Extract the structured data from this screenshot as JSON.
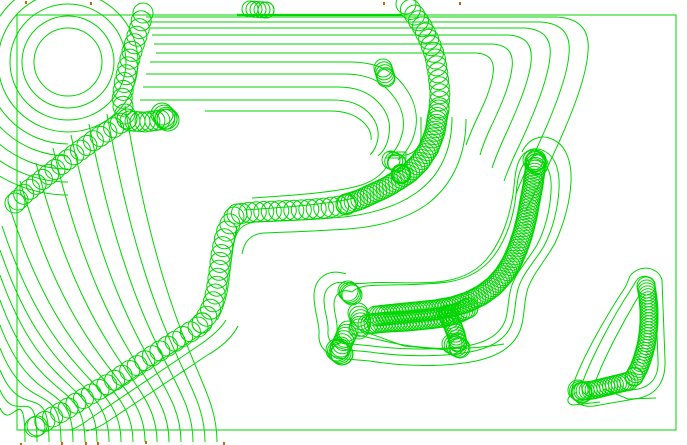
{
  "app": {
    "description": "CAM trochoidal toolpath preview viewport",
    "canvas": {
      "width": 687,
      "height": 445,
      "background": "#ffffff"
    },
    "colors": {
      "toolpath": "#00d600",
      "endpoint_marker": "#c86410"
    }
  },
  "border": {
    "x": 17,
    "y": 15,
    "w": 659,
    "h": 415
  },
  "boss_circles": [
    {
      "cx": 68,
      "cy": 62,
      "r": 34
    },
    {
      "cx": 68,
      "cy": 62,
      "r": 46
    },
    {
      "cx": 68,
      "cy": 62,
      "r": 58
    },
    {
      "cx": 68,
      "cy": 62,
      "r": 70
    }
  ],
  "boss_half_arc_radii": [
    82,
    94,
    107,
    120,
    133
  ],
  "boss_center": {
    "cx": 68,
    "cy": 62
  },
  "bold_circle": {
    "cx": 401,
    "cy": 174,
    "r": 9,
    "sw": 2.4
  },
  "thick_segments": [
    {
      "d": "M 237 15 L 402 15",
      "sw": 2.2
    }
  ],
  "contours": [
    "M 146 17 H 556 C 580 18 590 30 588 52 C 586 82 566 128 548 166 C 540 183 532 198 526 210",
    "M 148 22 H 540 C 562 23 571 34 569 54 C 567 80 550 120 535 152 C 528 166 521 180 516 194",
    "M 150 28 H 524 C 544 29 552 39 550 57 C 548 80 533 116 519 146 C 513 158 508 170 504 181",
    "M 152 35 H 508 C 526 36 533 45 531 62 C 529 82 516 112 504 138 C 499 149 495 159 492 168",
    "M 154 44 H 492 C 508 45 514 53 512 68 C 510 86 499 110 489 131 C 485 140 482 148 480 155",
    "M 156 53 H 476 C 490 54 495 61 493 74 C 491 90 482 108 474 125 C 471 132 468 139 466 145",
    "M 150 62 H 350 C 372 62 388 68 399 80 C 412 94 418 110 416 126 C 414 140 408 151 398 160",
    "M 146 74 H 344 C 364 74 378 79 388 90 C 400 102 405 116 403 130 C 401 141 396 151 388 158",
    "M 143 87 H 338 C 356 87 368 92 377 101 C 387 111 391 122 389 134 C 388 143 384 151 378 156",
    "M 140 100 H 333 C 349 100 360 104 368 112 C 376 120 379 129 378 138 C 377 145 374 151 370 155",
    "M 205 111 H 330 C 344 111 354 114 362 121 C 369 127 372 134 371 140",
    "M 421 117 L 421 136 C 421 146 415 153 406 155 L 388 156",
    "M 386 152 L 406 152 L 406 158 L 386 158",
    "M 452 117 C 452 150 440 176 416 193 C 396 207 370 214 344 217 C 312 220 282 221 256 222 C 242 223 236 231 234 243",
    "M 466 119 C 466 156 452 186 426 205 C 404 220 376 227 348 229 C 318 231 290 232 264 233 C 250 234 244 242 242 254",
    "M 252 198 C 300 195 336 192 358 186 C 372 182 380 176 386 168",
    "M 244 210 C 290 207 330 204 354 198",
    "M 237 226 C 233 244 231 262 229 280 C 227 296 223 310 217 320",
    "M 212 326 C 196 338 178 350 160 360 L 104 398",
    "M 226 320 C 220 330 210 338 198 346 L 88 420 C 80 426 74 429 70 430",
    "M 238 326 C 232 338 220 348 206 356 L 110 420 C 100 427 92 430 86 431",
    "M 352 292 C 342 288 334 294 334 304 C 334 314 338 322 337 330 C 336 338 342 343 352 344 L 372 346 C 404 350 440 350 466 346 C 490 342 502 332 506 318 C 509 306 508 296 512 285 C 517 271 528 260 537 245 C 545 230 550 210 551 192 C 552 177 549 166 541 161 C 533 156 525 160 521 169 C 516 180 517 194 514 208 C 510 228 503 244 493 257 C 482 271 467 279 448 282 C 420 286 384 284 366 286 C 360 287 355 289 352 292 Z",
    "M 349 284 C 335 279 324 287 324 300 C 324 312 329 322 328 331 C 327 341 334 348 348 350 L 370 352 C 404 357 442 357 470 352 C 496 347 509 336 513 320 C 516 307 515 297 519 286 C 524 272 535 261 544 246 C 553 229 558 208 559 189 C 560 172 556 158 546 152 C 535 145 524 150 519 161 C 514 172 515 186 512 200 C 508 222 501 240 490 255 C 479 270 464 278 445 281 C 418 285 386 281 368 283 C 360 284 353 283 349 284 Z",
    "M 346 274 C 328 268 314 278 314 296 C 314 312 320 324 319 334 C 318 348 328 357 346 359 L 370 361 C 406 367 446 367 476 361 C 504 355 518 342 522 324 C 525 310 524 300 528 288 C 534 272 546 260 555 243 C 564 224 570 202 571 182 C 572 162 566 146 554 140 C 541 133 528 139 522 152",
    "M 352 334 L 398 344 C 430 350 470 350 504 344",
    "M 360 330 L 404 346 L 448 350",
    "M 636 281 C 641 274 652 275 655 283 L 658 360 C 659 376 652 386 638 389 L 596 396 C 585 398 579 391 583 381 C 592 357 612 318 630 291 Z",
    "M 630 276 C 639 264 658 266 662 280 L 665 360 C 666 382 656 394 640 398 L 594 406 C 577 408 568 397 574 382 C 584 355 606 316 626 286 Z",
    "M 640 294 C 624 320 606 354 596 380",
    "M 577 392 L 570 396 C 566 400 568 405 574 405 L 600 402",
    "M 604 389 L 628 399 L 656 398"
  ],
  "fan_curves": [
    {
      "s": [
        0,
        408
      ],
      "e": [
        25,
        442
      ]
    },
    {
      "s": [
        0,
        390
      ],
      "e": [
        37,
        442
      ]
    },
    {
      "s": [
        0,
        370
      ],
      "e": [
        49,
        442
      ]
    },
    {
      "s": [
        0,
        348
      ],
      "e": [
        61,
        442
      ]
    },
    {
      "s": [
        0,
        325
      ],
      "e": [
        73,
        442
      ]
    },
    {
      "s": [
        0,
        300
      ],
      "e": [
        85,
        442
      ]
    },
    {
      "s": [
        0,
        275
      ],
      "e": [
        97,
        442
      ]
    },
    {
      "s": [
        0,
        250
      ],
      "e": [
        109,
        442
      ]
    },
    {
      "s": [
        2,
        226
      ],
      "e": [
        121,
        442
      ]
    },
    {
      "s": [
        8,
        202
      ],
      "e": [
        133,
        442
      ]
    },
    {
      "s": [
        20,
        181
      ],
      "e": [
        145,
        442
      ]
    },
    {
      "s": [
        36,
        163
      ],
      "e": [
        157,
        442
      ]
    },
    {
      "s": [
        53,
        148
      ],
      "e": [
        169,
        442
      ]
    },
    {
      "s": [
        71,
        135
      ],
      "e": [
        181,
        442
      ]
    },
    {
      "s": [
        89,
        124
      ],
      "e": [
        193,
        442
      ]
    },
    {
      "s": [
        107,
        114
      ],
      "e": [
        205,
        442
      ]
    },
    {
      "s": [
        125,
        106
      ],
      "e": [
        217,
        442
      ]
    }
  ],
  "chains": [
    {
      "name": "boss-descent",
      "r": 10,
      "step": 8,
      "pts": [
        [
          143,
          13
        ],
        [
          139,
          30
        ],
        [
          133,
          48
        ],
        [
          128,
          66
        ],
        [
          124,
          84
        ],
        [
          122,
          100
        ],
        [
          124,
          112
        ],
        [
          127,
          119
        ]
      ]
    },
    {
      "name": "boss-diagonal",
      "r": 10,
      "step": 8,
      "pts": [
        [
          127,
          119
        ],
        [
          110,
          130
        ],
        [
          93,
          141
        ],
        [
          75,
          154
        ],
        [
          57,
          168
        ],
        [
          39,
          182
        ],
        [
          24,
          194
        ],
        [
          15,
          203
        ]
      ]
    },
    {
      "name": "boss-stub",
      "r": 10,
      "step": 5,
      "pts": [
        [
          130,
          121
        ],
        [
          145,
          122
        ],
        [
          160,
          120
        ],
        [
          167,
          119
        ]
      ]
    },
    {
      "name": "stub-bulb",
      "r": 11,
      "step": 3,
      "pts": [
        [
          162,
          114
        ],
        [
          168,
          120
        ]
      ]
    },
    {
      "name": "top-cluster",
      "r": 8,
      "step": 4,
      "pts": [
        [
          250,
          9
        ],
        [
          266,
          10
        ]
      ]
    },
    {
      "name": "right-chain-top",
      "r": 10,
      "step": 7,
      "pts": [
        [
          406,
          4
        ],
        [
          414,
          14
        ],
        [
          422,
          26
        ],
        [
          429,
          40
        ],
        [
          435,
          56
        ],
        [
          438,
          74
        ],
        [
          440,
          92
        ],
        [
          439,
          110
        ]
      ]
    },
    {
      "name": "right-bend-dense",
      "r": 10,
      "step": 3.5,
      "pts": [
        [
          438,
          114
        ],
        [
          435,
          132
        ],
        [
          429,
          148
        ],
        [
          420,
          162
        ],
        [
          409,
          173
        ],
        [
          397,
          181
        ],
        [
          385,
          188
        ],
        [
          372,
          194
        ],
        [
          359,
          200
        ],
        [
          346,
          204
        ]
      ]
    },
    {
      "name": "mid-horizontal",
      "r": 10,
      "step": 7.5,
      "pts": [
        [
          346,
          205
        ],
        [
          325,
          208
        ],
        [
          300,
          210
        ],
        [
          275,
          211
        ],
        [
          252,
          212
        ],
        [
          237,
          214
        ]
      ]
    },
    {
      "name": "mid-vertical",
      "r": 10,
      "step": 8,
      "pts": [
        [
          234,
          217
        ],
        [
          228,
          227
        ],
        [
          224,
          240
        ],
        [
          221,
          255
        ],
        [
          219,
          270
        ],
        [
          217,
          285
        ],
        [
          214,
          300
        ],
        [
          209,
          313
        ],
        [
          202,
          323
        ]
      ]
    },
    {
      "name": "staircase",
      "r": 10,
      "step": 9,
      "pts": [
        [
          198,
          327
        ],
        [
          182,
          337
        ],
        [
          166,
          347
        ],
        [
          149,
          358
        ],
        [
          132,
          369
        ],
        [
          115,
          380
        ],
        [
          98,
          390
        ],
        [
          81,
          400
        ],
        [
          65,
          410
        ],
        [
          49,
          419
        ],
        [
          35,
          427
        ]
      ]
    },
    {
      "name": "right-top-bulb",
      "r": 9,
      "step": 3,
      "pts": [
        [
          383,
          68
        ],
        [
          386,
          78
        ]
      ]
    },
    {
      "name": "tab-bulb",
      "r": 9,
      "step": 3,
      "pts": [
        [
          391,
          160
        ],
        [
          397,
          163
        ]
      ]
    },
    {
      "name": "bench-upper-row",
      "r": 10,
      "step": 3,
      "pts": [
        [
          376,
          316
        ],
        [
          395,
          314
        ],
        [
          415,
          312
        ],
        [
          435,
          310
        ],
        [
          452,
          307
        ],
        [
          468,
          302
        ],
        [
          482,
          295
        ],
        [
          494,
          286
        ],
        [
          504,
          275
        ],
        [
          512,
          262
        ],
        [
          518,
          248
        ],
        [
          523,
          233
        ],
        [
          527,
          217
        ],
        [
          530,
          201
        ],
        [
          533,
          185
        ],
        [
          535,
          170
        ],
        [
          536,
          160
        ]
      ]
    },
    {
      "name": "bench-lower-row",
      "r": 10,
      "step": 3,
      "pts": [
        [
          368,
          324
        ],
        [
          388,
          322
        ],
        [
          408,
          321
        ],
        [
          428,
          319
        ],
        [
          444,
          317
        ],
        [
          458,
          313
        ],
        [
          468,
          308
        ]
      ]
    },
    {
      "name": "bench-top-bulb",
      "r": 10,
      "step": 2.5,
      "pts": [
        [
          533,
          160
        ],
        [
          538,
          165
        ]
      ]
    },
    {
      "name": "bench-left-top",
      "r": 10,
      "step": 2,
      "pts": [
        [
          348,
          291
        ],
        [
          352,
          295
        ]
      ]
    },
    {
      "name": "bench-left-mid",
      "r": 10,
      "step": 3.5,
      "pts": [
        [
          358,
          313
        ],
        [
          361,
          321
        ],
        [
          359,
          329
        ]
      ]
    },
    {
      "name": "bench-left-down",
      "r": 10,
      "step": 3.5,
      "pts": [
        [
          348,
          331
        ],
        [
          344,
          340
        ],
        [
          340,
          349
        ]
      ]
    },
    {
      "name": "bench-left-bulb",
      "r": 11,
      "step": 2,
      "pts": [
        [
          337,
          350
        ],
        [
          342,
          354
        ]
      ]
    },
    {
      "name": "bench-mid-down",
      "r": 9,
      "step": 3,
      "pts": [
        [
          447,
          314
        ],
        [
          452,
          324
        ],
        [
          456,
          334
        ],
        [
          458,
          343
        ]
      ]
    },
    {
      "name": "bench-mid-bulb",
      "r": 10,
      "step": 2.5,
      "pts": [
        [
          452,
          344
        ],
        [
          460,
          348
        ]
      ]
    },
    {
      "name": "corner-vertical",
      "r": 9,
      "step": 3,
      "pts": [
        [
          646,
          286
        ],
        [
          648,
          298
        ],
        [
          649,
          310
        ],
        [
          649,
          322
        ],
        [
          648,
          334
        ],
        [
          646,
          346
        ],
        [
          643,
          357
        ],
        [
          639,
          368
        ],
        [
          634,
          377
        ]
      ]
    },
    {
      "name": "corner-horizontal",
      "r": 9,
      "step": 3,
      "pts": [
        [
          629,
          381
        ],
        [
          617,
          384
        ],
        [
          605,
          387
        ],
        [
          593,
          390
        ],
        [
          583,
          391
        ]
      ]
    },
    {
      "name": "corner-bulb",
      "r": 10,
      "step": 2,
      "pts": [
        [
          578,
          390
        ],
        [
          582,
          393
        ]
      ]
    }
  ],
  "endpoint_markers": [
    [
      25,
      1
    ],
    [
      90,
      2
    ],
    [
      383,
      2
    ],
    [
      459,
      2
    ],
    [
      20,
      443
    ],
    [
      61,
      442
    ],
    [
      85,
      442
    ],
    [
      97,
      442
    ],
    [
      145,
      441
    ],
    [
      223,
      442
    ]
  ]
}
